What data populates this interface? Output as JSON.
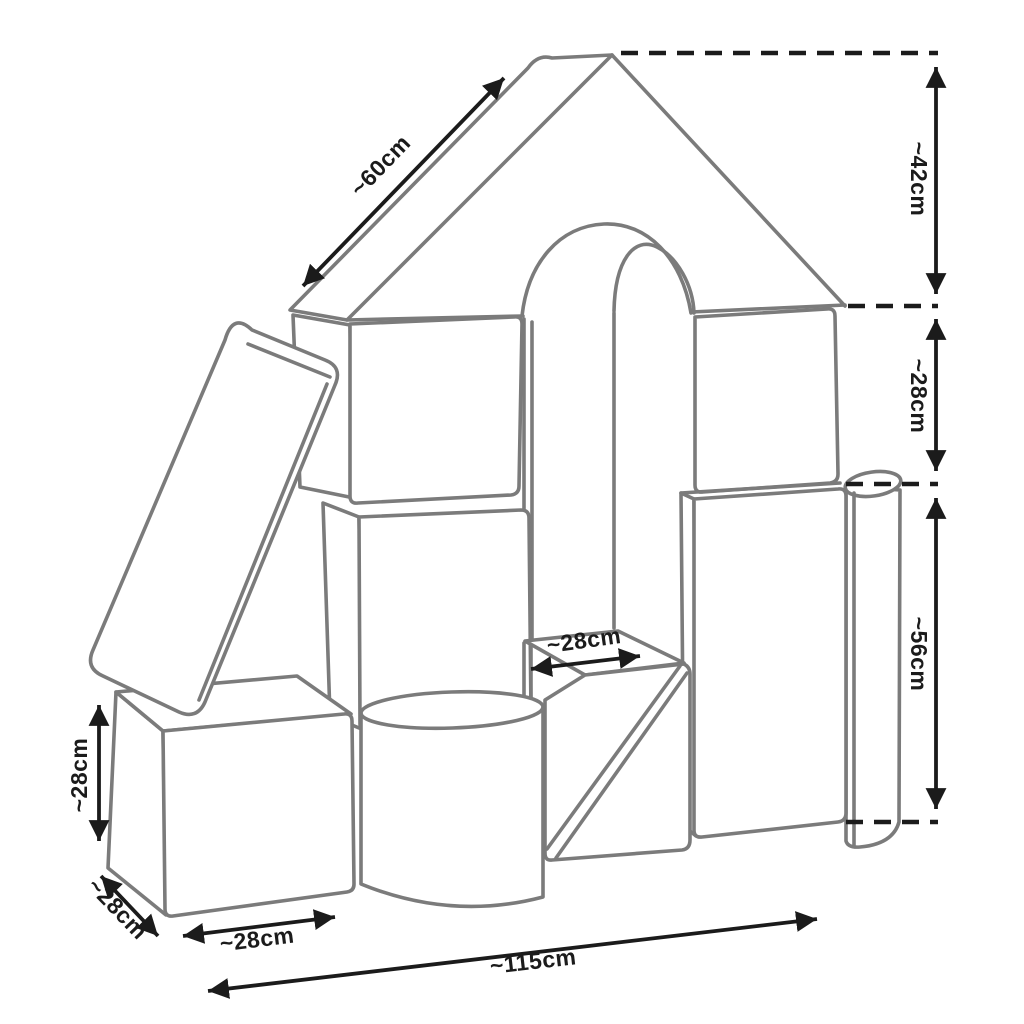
{
  "diagram": {
    "type": "product-dimension-line-drawing",
    "subject": "foam-play-blocks-house",
    "colors": {
      "background": "#ffffff",
      "block_outline": "#7b7b7b",
      "dimension": "#1b1b1b"
    },
    "labels": {
      "roof_slope_length": "~60cm",
      "roof_height": "~42cm",
      "upper_wall_height": "~28cm",
      "lower_wall_height": "~56cm",
      "wedge_top_width": "~28cm",
      "left_cube_height": "~28cm",
      "left_cube_depth": "~28cm",
      "left_cube_width": "~28cm",
      "total_width": "~115cm"
    }
  }
}
